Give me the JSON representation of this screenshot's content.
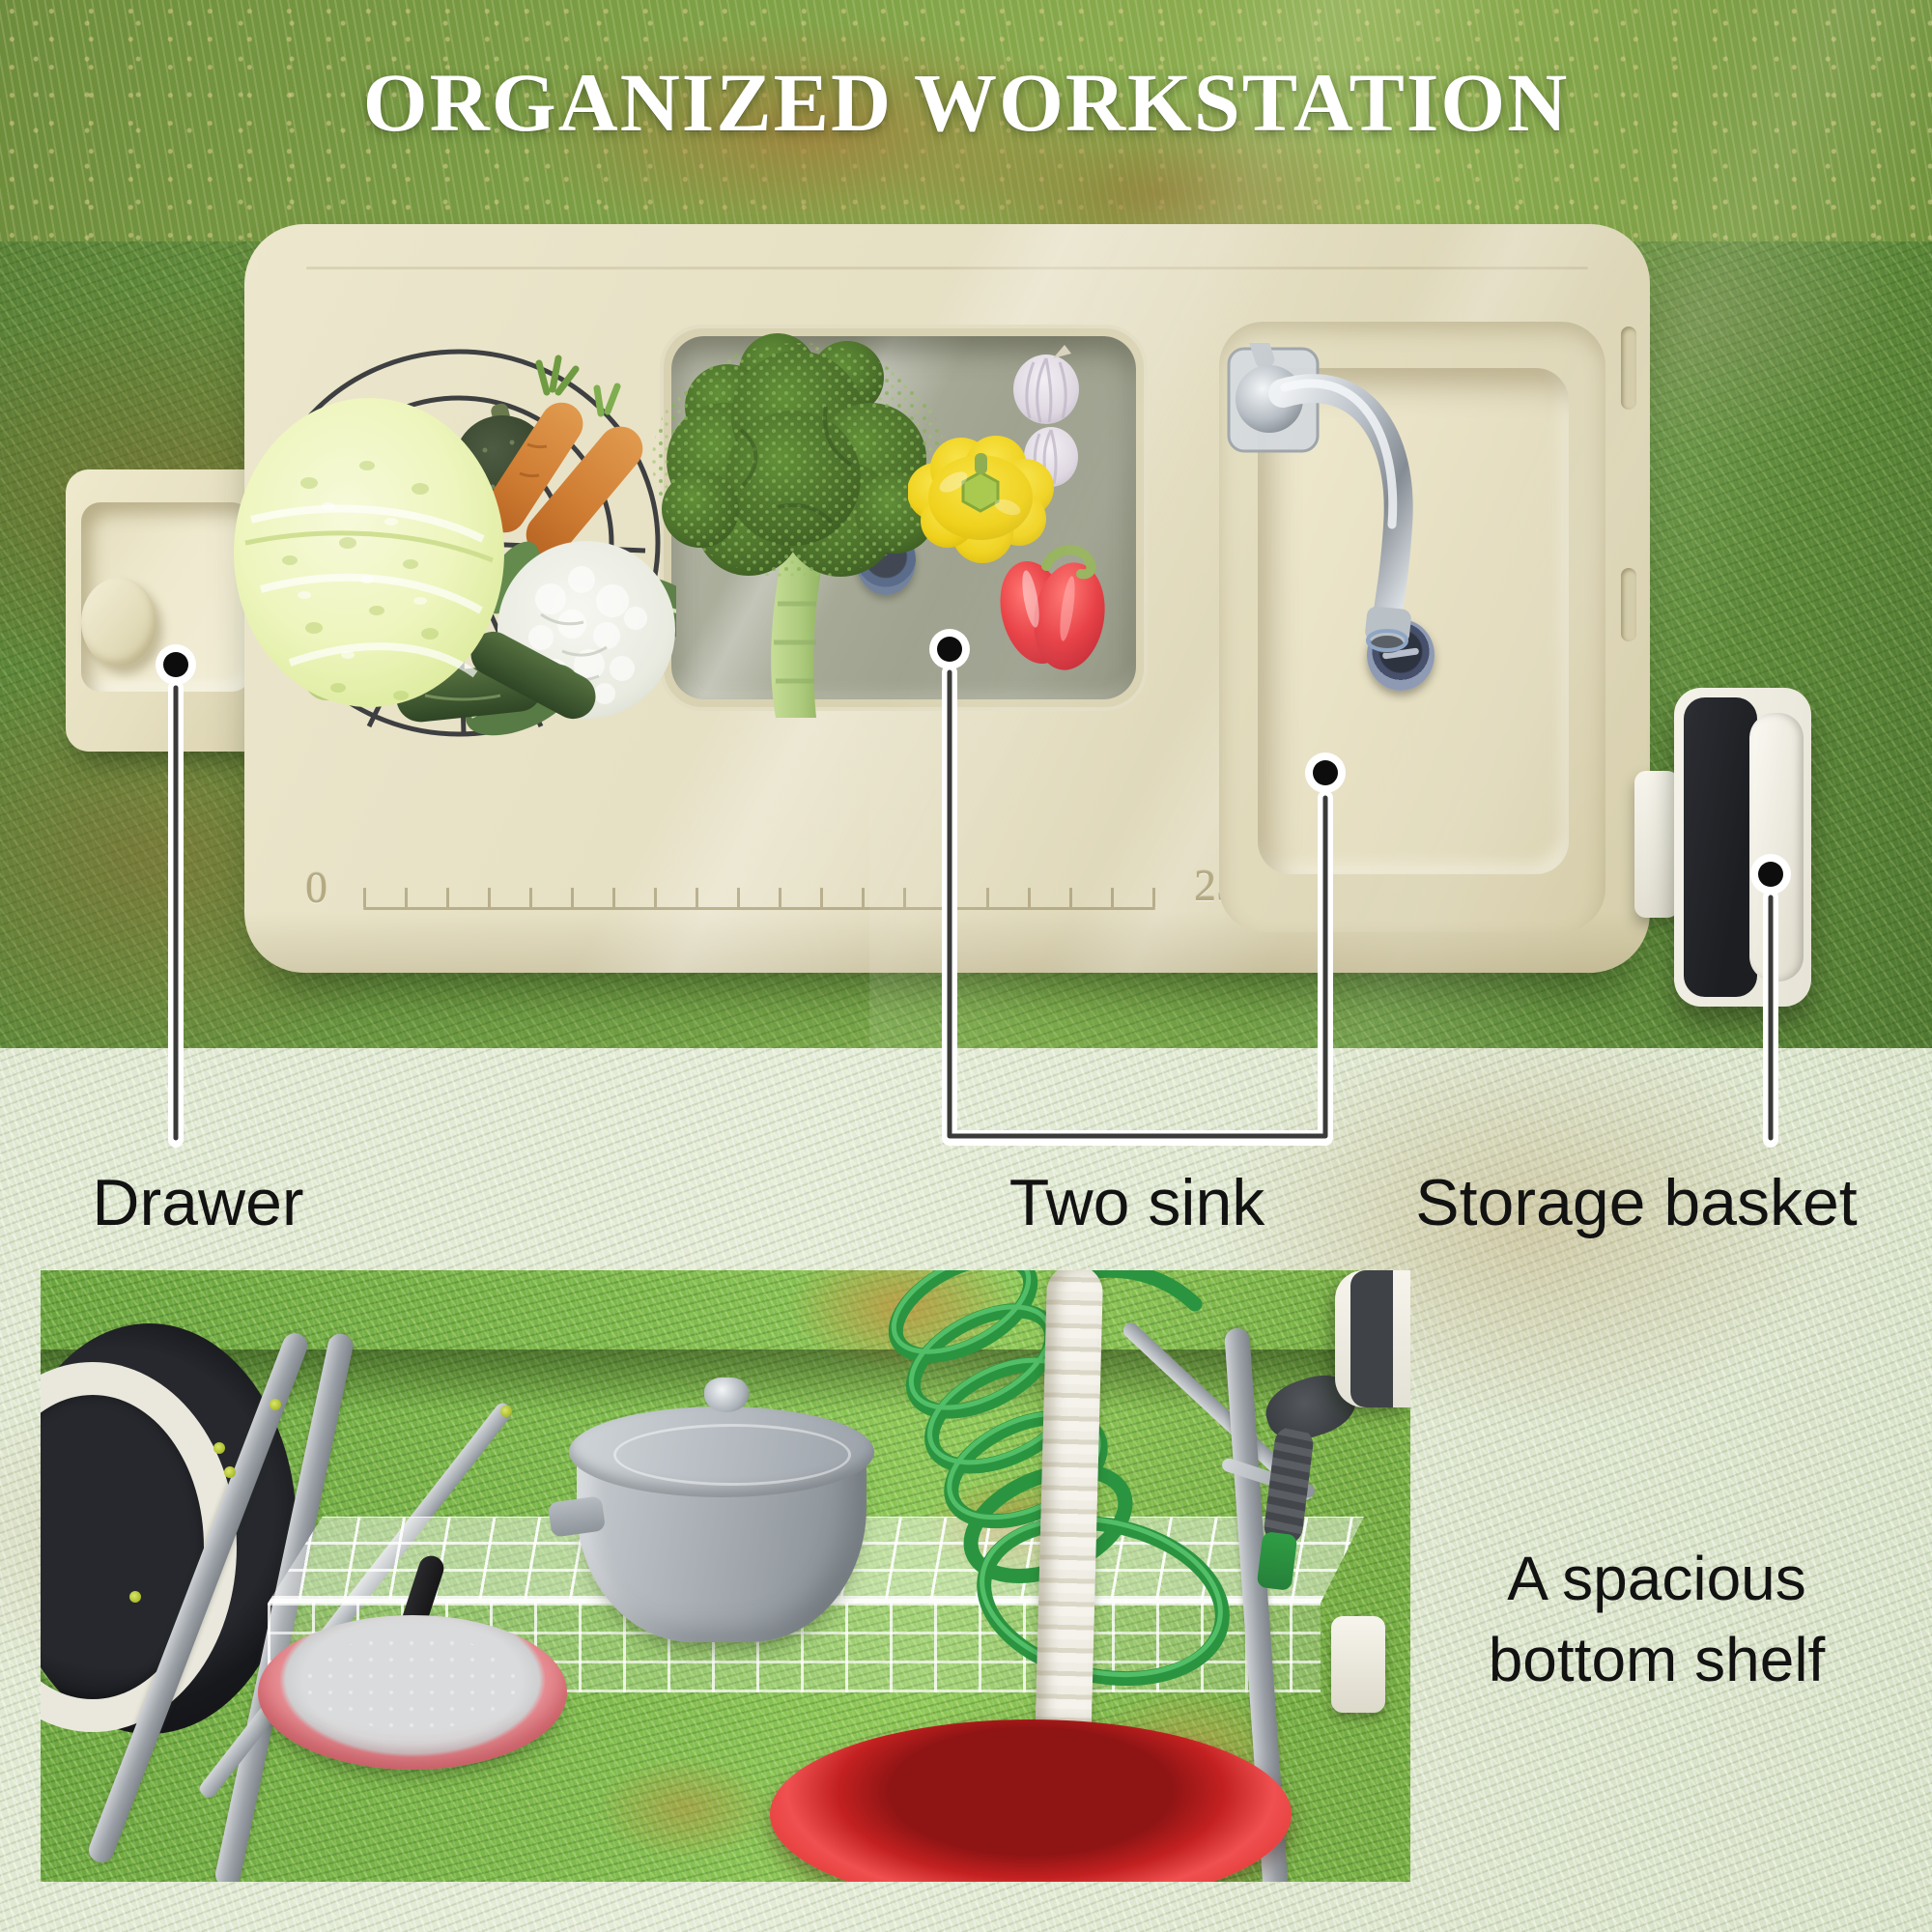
{
  "title": "ORGANIZED WORKSTATION",
  "callouts": {
    "drawer": "Drawer",
    "two_sink": "Two sink",
    "storage_basket": "Storage basket"
  },
  "bottom_caption": "A spacious bottom shelf",
  "ruler": {
    "start": "0",
    "end": "25"
  },
  "icons": {
    "callout_dot": "black dot with white ring",
    "callout_line": "white-cased leader line"
  },
  "colors": {
    "table_beige": "#e8e2c6",
    "grass_green": "#6f9c42",
    "title_text": "#ffffff",
    "label_text": "#121212",
    "callout_line": "#3a3a38",
    "bucket_red": "#d62b2b",
    "hose_green": "#2f9e44",
    "pan_pink": "#e0747c",
    "pot_gray": "#a8aeb4",
    "water_gray": "#a6a996"
  }
}
